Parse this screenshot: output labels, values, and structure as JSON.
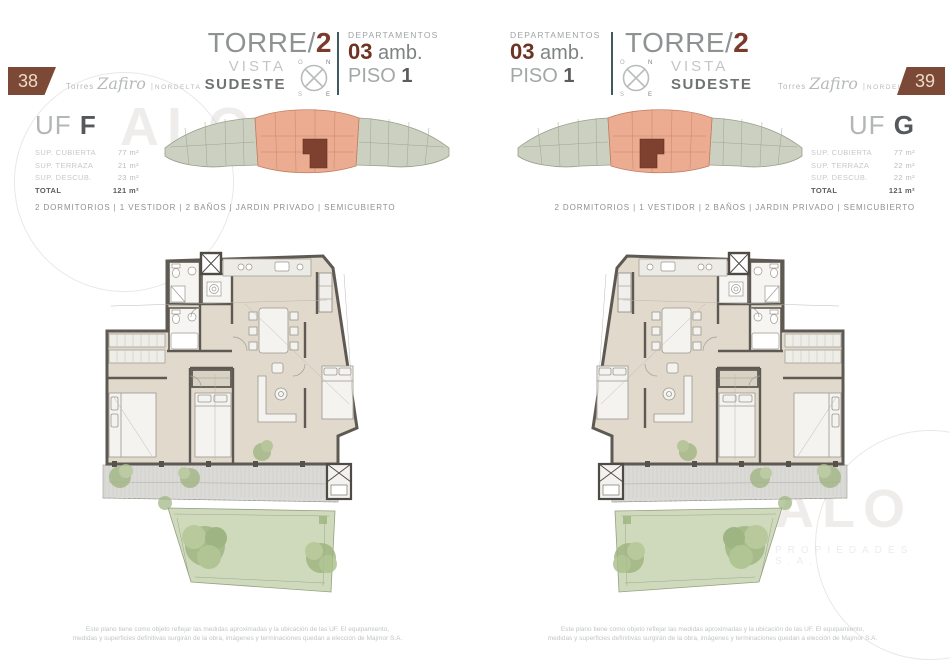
{
  "brand": {
    "logo_prefix": "Torres",
    "logo_name": "Zafiro",
    "logo_divider": "|",
    "logo_suffix": "NORDELTA",
    "watermark_word": "ALO",
    "watermark_sub": "PROPIEDADES S.A."
  },
  "shared": {
    "torre_label": "TORRE/",
    "torre_number": "2",
    "vista_label": "VISTA",
    "vista_direction": "SUDESTE",
    "departamentos_label": "DEPARTAMENTOS",
    "ambientes_number": "03",
    "ambientes_label": "amb.",
    "piso_label": "PISO",
    "piso_number": "1",
    "compass": {
      "nw": "O",
      "ne": "N",
      "sw": "S",
      "se": "E"
    },
    "features": "2 DORMITORIOS | 1 VESTIDOR | 2 BAÑOS | JARDIN PRIVADO | SEMICUBIERTO",
    "disclaimer_line1": "Este plano tiene como objeto reflejar las medidas aproximadas y la ubicación de las UF. El equipamiento,",
    "disclaimer_line2": "medidas y superficies definitivas surgirán de la obra, imágenes y terminaciones quedan a elección de Majmor S.A."
  },
  "pages": [
    {
      "page_number": "38",
      "unit_label": "UF",
      "unit_letter": "F",
      "surfaces": {
        "rows": [
          {
            "label": "SUP. CUBIERTA",
            "value": "77 m²"
          },
          {
            "label": "SUP. TERRAZA",
            "value": "21 m²"
          },
          {
            "label": "SUP. DESCUB.",
            "value": "23 m²"
          }
        ],
        "total_label": "TOTAL",
        "total_value": "121 m²"
      }
    },
    {
      "page_number": "39",
      "unit_label": "UF",
      "unit_letter": "G",
      "surfaces": {
        "rows": [
          {
            "label": "SUP. CUBIERTA",
            "value": "77 m²"
          },
          {
            "label": "SUP. TERRAZA",
            "value": "22 m²"
          },
          {
            "label": "SUP. DESCUB.",
            "value": "22 m²"
          }
        ],
        "total_label": "TOTAL",
        "total_value": "121 m²"
      }
    }
  ],
  "colors": {
    "accent_brown": "#7a3b2a",
    "badge_brown": "#7c4936",
    "divider_teal": "#3f5a62",
    "keyplan_highlight": "#ecac91",
    "keyplan_unit": "#7e4130",
    "garden_green": "#cfd9bc",
    "plan_floor": "#e1dacc",
    "plan_wall": "#5e5a53"
  }
}
